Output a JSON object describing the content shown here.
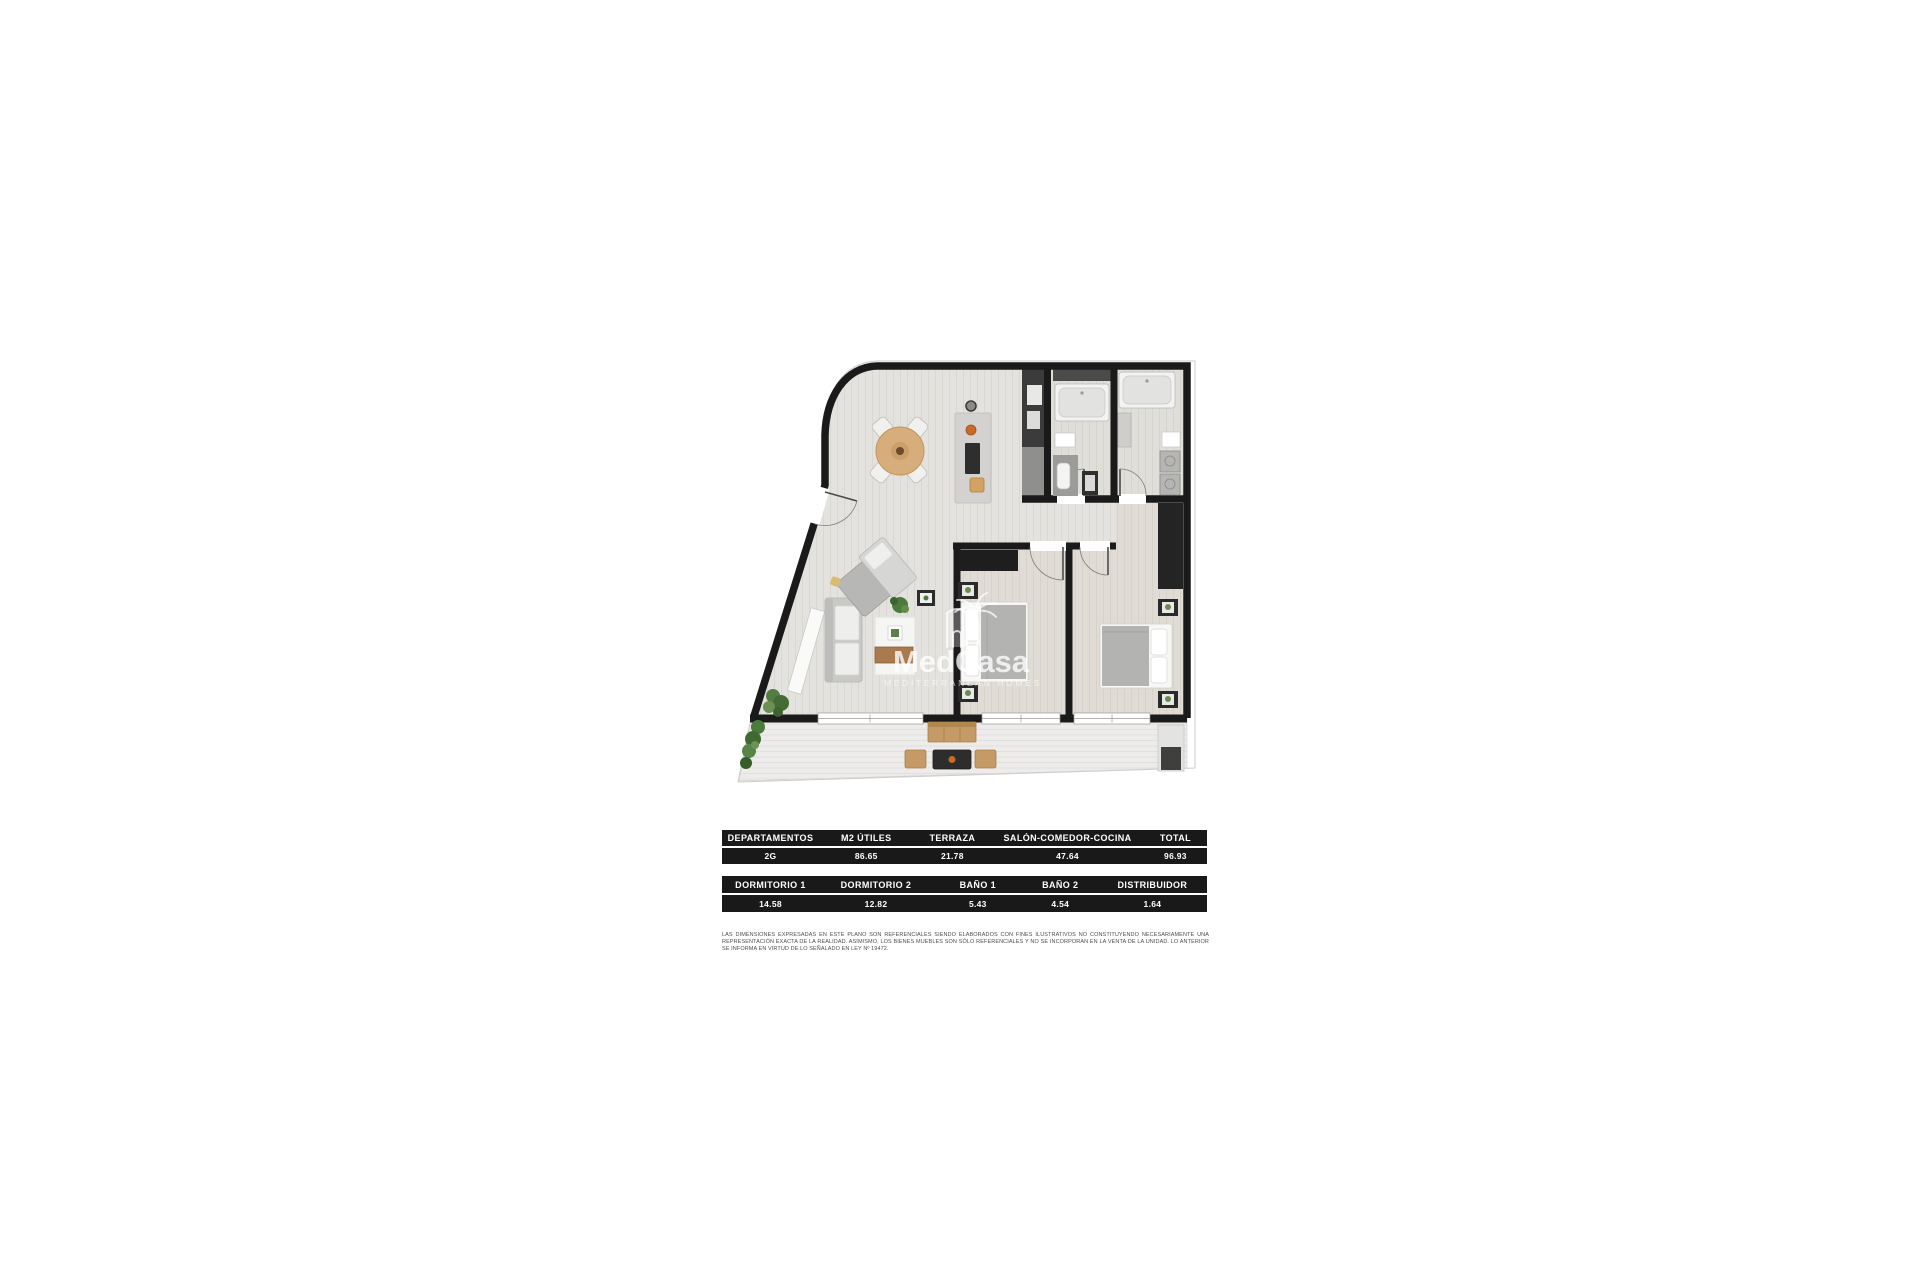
{
  "watermark": {
    "brand": "MedCasa",
    "tagline": "MEDITERRANEAN HOMES",
    "logo_icon": "palm-tree-over-building"
  },
  "tables": {
    "summary": {
      "headers": [
        "DEPARTAMENTOS",
        "M2 ÚTILES",
        "TERRAZA",
        "SALÓN-COMEDOR-COCINA",
        "TOTAL"
      ],
      "values": [
        "2G",
        "86.65",
        "21.78",
        "47.64",
        "96.93"
      ]
    },
    "rooms": {
      "headers": [
        "DORMITORIO 1",
        "DORMITORIO 2",
        "BAÑO 1",
        "BAÑO 2",
        "DISTRIBUIDOR"
      ],
      "values": [
        "14.58",
        "12.82",
        "5.43",
        "4.54",
        "1.64"
      ]
    }
  },
  "disclaimer": "LAS DIMENSIONES EXPRESADAS EN ESTE PLANO SON REFERENCIALES SIENDO ELABORADOS CON FINES ILUSTRATIVOS NO CONSTITUYENDO NECESARIAMENTE UNA REPRESENTACIÓN EXACTA DE LA REALIDAD. ASIMISMO, LOS BIENES MUEBLES SON SÓLO REFERENCIALES Y NO SE INCORPORAN EN LA VENTA DE LA UNIDAD.  LO ANTERIOR SE INFORMA EN VIRTUD DE LO SEÑALADO EN LEY Nº 19472.",
  "colors": {
    "wall": "#1a1a1a",
    "table_background": "#191919",
    "table_text": "#ffffff",
    "interior_floor": "#e4e2de",
    "terrace_floor": "#edecea",
    "wood": "#c49a66",
    "plant_green": "#4c7a3d",
    "accent_orange": "#c96a2a",
    "watermark_white": "#ffffff"
  }
}
